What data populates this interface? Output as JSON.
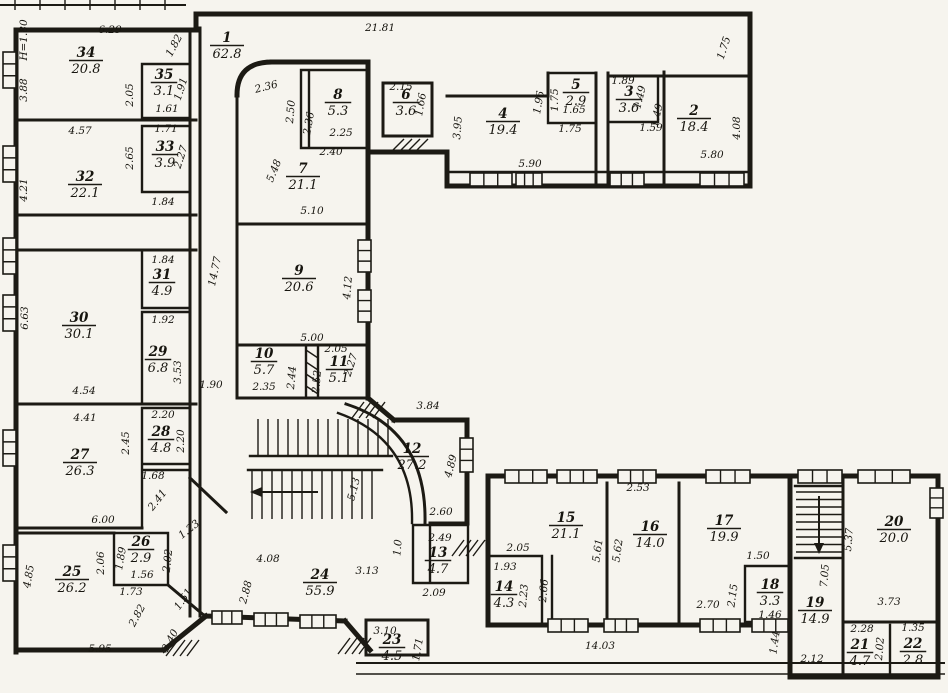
{
  "meta": {
    "drawing_type": "apartment-building floor plan (scanned blueprint)",
    "paper_color": "#f6f4ee",
    "ink_color": "#1c1a14",
    "height_mark": "H=1.80"
  },
  "rooms": [
    {
      "n": "1",
      "area": "62.8",
      "x": 227,
      "y": 42
    },
    {
      "n": "2",
      "area": "18.4",
      "x": 694,
      "y": 115
    },
    {
      "n": "3",
      "area": "3.6",
      "x": 629,
      "y": 96
    },
    {
      "n": "4",
      "area": "19.4",
      "x": 503,
      "y": 118
    },
    {
      "n": "5",
      "area": "2.9",
      "x": 576,
      "y": 89
    },
    {
      "n": "6",
      "area": "3.6",
      "x": 406,
      "y": 99
    },
    {
      "n": "7",
      "area": "21.1",
      "x": 303,
      "y": 173
    },
    {
      "n": "8",
      "area": "5.3",
      "x": 338,
      "y": 99
    },
    {
      "n": "9",
      "area": "20.6",
      "x": 299,
      "y": 275
    },
    {
      "n": "10",
      "area": "5.7",
      "x": 264,
      "y": 358
    },
    {
      "n": "11",
      "area": "5.1",
      "x": 339,
      "y": 366
    },
    {
      "n": "12",
      "area": "27.2",
      "x": 412,
      "y": 453
    },
    {
      "n": "13",
      "area": "4.7",
      "x": 438,
      "y": 557
    },
    {
      "n": "14",
      "area": "4.3",
      "x": 504,
      "y": 591
    },
    {
      "n": "15",
      "area": "21.1",
      "x": 566,
      "y": 522
    },
    {
      "n": "16",
      "area": "14.0",
      "x": 650,
      "y": 531
    },
    {
      "n": "17",
      "area": "19.9",
      "x": 724,
      "y": 525
    },
    {
      "n": "18",
      "area": "3.3",
      "x": 770,
      "y": 589
    },
    {
      "n": "19",
      "area": "14.9",
      "x": 815,
      "y": 607
    },
    {
      "n": "20",
      "area": "20.0",
      "x": 894,
      "y": 526
    },
    {
      "n": "21",
      "area": "4.7",
      "x": 860,
      "y": 649
    },
    {
      "n": "22",
      "area": "2.8",
      "x": 913,
      "y": 648
    },
    {
      "n": "23",
      "area": "4.5",
      "x": 392,
      "y": 644
    },
    {
      "n": "24",
      "area": "55.9",
      "x": 320,
      "y": 579
    },
    {
      "n": "25",
      "area": "26.2",
      "x": 72,
      "y": 576
    },
    {
      "n": "26",
      "area": "2.9",
      "x": 141,
      "y": 546
    },
    {
      "n": "27",
      "area": "26.3",
      "x": 80,
      "y": 459
    },
    {
      "n": "28",
      "area": "4.8",
      "x": 161,
      "y": 436
    },
    {
      "n": "29",
      "area": "6.8",
      "x": 158,
      "y": 356
    },
    {
      "n": "30",
      "area": "30.1",
      "x": 79,
      "y": 322
    },
    {
      "n": "31",
      "area": "4.9",
      "x": 162,
      "y": 279
    },
    {
      "n": "32",
      "area": "22.1",
      "x": 85,
      "y": 181
    },
    {
      "n": "33",
      "area": "3.9",
      "x": 165,
      "y": 151
    },
    {
      "n": "34",
      "area": "20.8",
      "x": 86,
      "y": 57
    },
    {
      "n": "35",
      "area": "3.1",
      "x": 164,
      "y": 79
    }
  ],
  "dims": [
    [
      "6.29",
      110,
      33,
      0
    ],
    [
      "1.82",
      177,
      47,
      -62
    ],
    [
      "H=1.80",
      27,
      40,
      -90
    ],
    [
      "3.88",
      27,
      90,
      -90
    ],
    [
      "2.05",
      133,
      95,
      -90
    ],
    [
      "1.91",
      184,
      90,
      -72
    ],
    [
      "1.61",
      167,
      112,
      0
    ],
    [
      "4.57",
      80,
      134,
      0
    ],
    [
      "1.71",
      166,
      132,
      0
    ],
    [
      "2.65",
      133,
      158,
      -90
    ],
    [
      "2.27",
      184,
      158,
      -72
    ],
    [
      "4.21",
      27,
      190,
      -90
    ],
    [
      "1.84",
      163,
      205,
      0
    ],
    [
      "1.84",
      163,
      263,
      0
    ],
    [
      "6.63",
      28,
      318,
      -90
    ],
    [
      "1.92",
      163,
      323,
      0
    ],
    [
      "3.53",
      181,
      372,
      -90
    ],
    [
      "4.54",
      84,
      394,
      0
    ],
    [
      "14.77",
      218,
      272,
      -78
    ],
    [
      "1.90",
      211,
      388,
      0
    ],
    [
      "4.41",
      85,
      421,
      0
    ],
    [
      "2.20",
      163,
      418,
      0
    ],
    [
      "2.45",
      129,
      443,
      -90
    ],
    [
      "2.20",
      184,
      441,
      -90
    ],
    [
      "1.68",
      153,
      479,
      0
    ],
    [
      "2.41",
      160,
      502,
      -52
    ],
    [
      "6.00",
      103,
      523,
      0
    ],
    [
      "1.23",
      191,
      532,
      -38
    ],
    [
      "1.89",
      124,
      559,
      -80
    ],
    [
      "2.06",
      104,
      563,
      -90
    ],
    [
      "2.02",
      171,
      561,
      -84
    ],
    [
      "1.56",
      142,
      578,
      0
    ],
    [
      "1.73",
      131,
      595,
      0
    ],
    [
      "1.51",
      186,
      601,
      -55
    ],
    [
      "4.85",
      32,
      577,
      -80
    ],
    [
      "2.82",
      140,
      617,
      -62
    ],
    [
      "2.40",
      173,
      642,
      -62
    ],
    [
      "5.95",
      100,
      652,
      0
    ],
    [
      "2.88",
      249,
      593,
      -75
    ],
    [
      "21.81",
      380,
      31,
      0
    ],
    [
      "1.75",
      727,
      49,
      -72
    ],
    [
      "2.36",
      267,
      90,
      -14
    ],
    [
      "2.50",
      294,
      112,
      -85
    ],
    [
      "2.36",
      312,
      124,
      -80
    ],
    [
      "2.25",
      341,
      136,
      0
    ],
    [
      "2.40",
      331,
      155,
      0
    ],
    [
      "5.48",
      277,
      172,
      -68
    ],
    [
      "5.10",
      312,
      214,
      0
    ],
    [
      "2.15",
      401,
      90,
      0
    ],
    [
      "1.66",
      424,
      105,
      -80
    ],
    [
      "3.95",
      461,
      128,
      -86
    ],
    [
      "5.90",
      530,
      167,
      0
    ],
    [
      "1.96",
      542,
      103,
      -80
    ],
    [
      "1.75",
      558,
      100,
      -90
    ],
    [
      "1.65",
      574,
      113,
      0
    ],
    [
      "1.75",
      570,
      132,
      0
    ],
    [
      "1.89",
      623,
      84,
      0
    ],
    [
      "1.49",
      643,
      98,
      -76
    ],
    [
      "1.49",
      660,
      116,
      -76
    ],
    [
      "1.59",
      651,
      131,
      0
    ],
    [
      "5.80",
      712,
      158,
      0
    ],
    [
      "4.08",
      740,
      128,
      -90
    ],
    [
      "4.12",
      351,
      288,
      -85
    ],
    [
      "5.00",
      312,
      341,
      0
    ],
    [
      "2.05",
      336,
      352,
      0
    ],
    [
      "2.35",
      264,
      390,
      0
    ],
    [
      "2.44",
      295,
      378,
      -85
    ],
    [
      "2.52",
      320,
      382,
      -85
    ],
    [
      "2.27",
      354,
      366,
      -72
    ],
    [
      "3.84",
      428,
      409,
      0
    ],
    [
      "5.13",
      357,
      490,
      -75
    ],
    [
      "4.89",
      454,
      467,
      -75
    ],
    [
      "2.60",
      441,
      515,
      0
    ],
    [
      "1.0",
      401,
      548,
      -85
    ],
    [
      "2.49",
      440,
      541,
      0
    ],
    [
      "2.09",
      434,
      596,
      0
    ],
    [
      "3.13",
      367,
      574,
      0
    ],
    [
      "4.08",
      268,
      562,
      0
    ],
    [
      "3.10",
      385,
      634,
      0
    ],
    [
      "1.71",
      421,
      650,
      -80
    ],
    [
      "14.03",
      600,
      649,
      0
    ],
    [
      "2.05",
      518,
      551,
      0
    ],
    [
      "1.93",
      505,
      570,
      0
    ],
    [
      "2.23",
      527,
      596,
      -85
    ],
    [
      "2.66",
      547,
      591,
      -85
    ],
    [
      "5.61",
      601,
      551,
      -82
    ],
    [
      "2.53",
      638,
      491,
      0
    ],
    [
      "5.62",
      621,
      551,
      -82
    ],
    [
      "2.70",
      708,
      608,
      0
    ],
    [
      "1.50",
      758,
      559,
      0
    ],
    [
      "2.15",
      736,
      596,
      -82
    ],
    [
      "1.46",
      770,
      618,
      0
    ],
    [
      "7.05",
      828,
      576,
      -85
    ],
    [
      "2.12",
      812,
      662,
      0
    ],
    [
      "1.44",
      778,
      643,
      -82
    ],
    [
      "5.37",
      852,
      540,
      -85
    ],
    [
      "3.73",
      889,
      605,
      0
    ],
    [
      "2.28",
      862,
      632,
      0
    ],
    [
      "2.02",
      883,
      649,
      -85
    ],
    [
      "1.35",
      913,
      631,
      0
    ]
  ]
}
